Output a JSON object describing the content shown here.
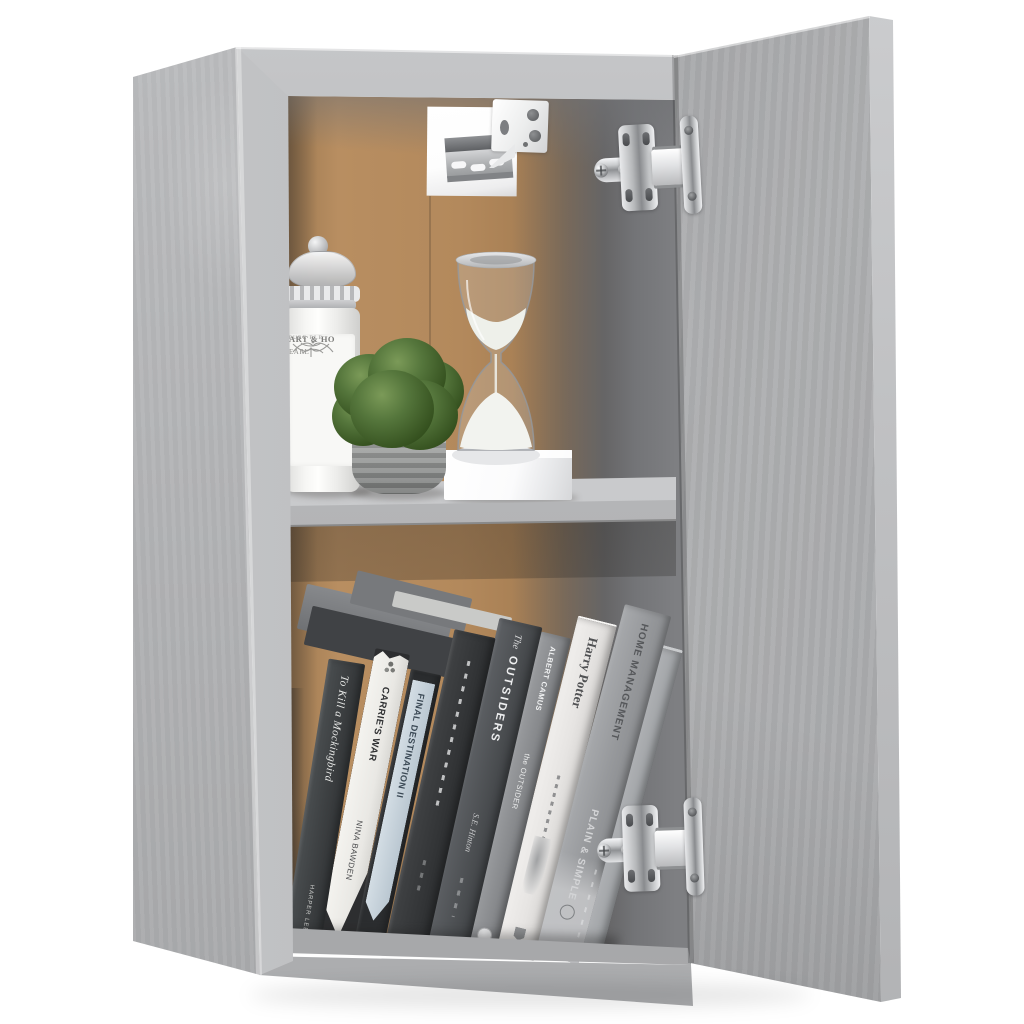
{
  "scene": {
    "type": "product-photo",
    "subject": "Wall-mounted cabinet in concrete grey with open door, two compartments decorated with jar, plant, hourglass and books",
    "background_color": "#ffffff"
  },
  "palette": {
    "panel_grey": "#b4b5b7",
    "panel_edge_grey": "#c6c7c9",
    "door_grey": "#a6a7a9",
    "interior_back_brown": "#ae855a",
    "interior_shadow_grey": "#737477",
    "shelf_grey": "#c2c3c5",
    "chrome": "#d9dadc",
    "foliage_green": "#4a6a35",
    "pot_grey": "#979998",
    "sand_white": "#f2f3ef"
  },
  "top_shelf": {
    "jar": {
      "label_lines": [
        "ART & HO",
        "PURE BLE",
        "EARL"
      ]
    },
    "plant": {
      "type": "faux boxwood bush in ribbed grey pot"
    },
    "hourglass": {
      "sand": "white",
      "base": "white block"
    }
  },
  "books": [
    {
      "title": "To Kill a Mockingbird",
      "author": "HARPER LEE"
    },
    {
      "title": "CARRIE'S WAR",
      "author": "NINA BAWDEN"
    },
    {
      "title": "FINAL DESTINATION II",
      "author": ""
    },
    {
      "title": "",
      "author": ""
    },
    {
      "pre": "The",
      "title": "OUTSIDERS",
      "author": "S.E. Hinton"
    },
    {
      "title": "the OUTSIDER",
      "author": "ALBERT CAMUS"
    },
    {
      "title": "Harry Potter",
      "author": ""
    },
    {
      "title": "HOME MANAGEMENT",
      "subtitle": "PLAIN & SIMPLE"
    },
    {
      "title": "",
      "author": ""
    }
  ],
  "hardware": {
    "hinges_count": 2,
    "hinge_finish": "chrome",
    "wall_bracket": "white cabinet hanger on slotted metal rail"
  }
}
